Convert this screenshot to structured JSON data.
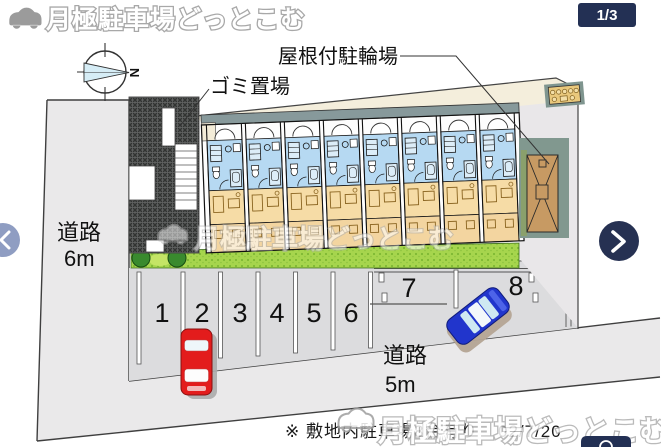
{
  "header": {
    "brand": "月極駐車場どっとこむ",
    "pager": "1/3"
  },
  "carousel": {
    "icons": {
      "prev": "chevron-left",
      "next": "chevron-right"
    }
  },
  "plan": {
    "compass_label": "N",
    "labels": {
      "bike_shed": "屋根付駐輪場",
      "garbage": "ゴミ置場",
      "road_west_name": "道路",
      "road_west_width": "6m",
      "road_south_name": "道路",
      "road_south_width": "5m"
    },
    "parking_spaces": [
      "1",
      "2",
      "3",
      "4",
      "5",
      "6",
      "7",
      "8"
    ],
    "note": "※ 敷地内駐車場8台有り",
    "date": "02/7/20"
  },
  "watermark": {
    "text": "月極駐車場どっとこむ"
  },
  "colors": {
    "accent_navy": "#233054",
    "nav_prev_blue": "#8f9dc2",
    "car_red": "#e31c1c",
    "car_blue": "#2135cc",
    "grass_green": "#a6d54d",
    "roof_sage": "#87999b",
    "room_tan": "#f6dca6",
    "floor_blue": "#b6d9f2"
  }
}
